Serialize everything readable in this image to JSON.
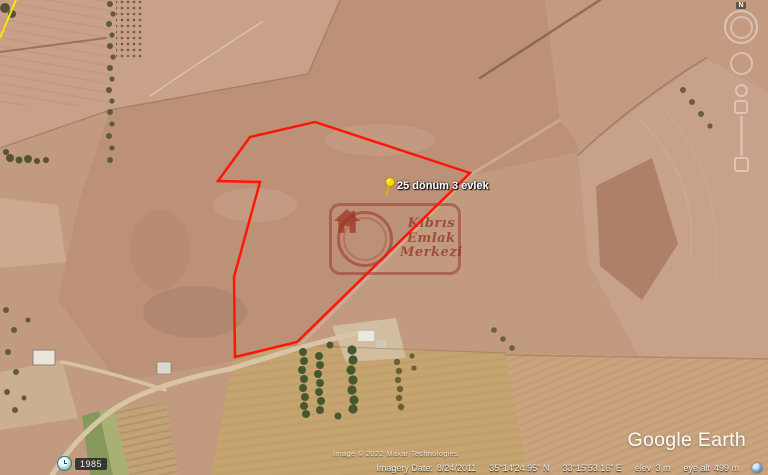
{
  "placemark": {
    "label": "25 dönüm 3 evlek"
  },
  "watermark": {
    "line1": "Kıbrıs",
    "line2": "Emlak",
    "line3": "Merkezi"
  },
  "nav": {
    "north_label": "N"
  },
  "time_badge": {
    "year": "1985"
  },
  "branding": {
    "logo": "Google Earth"
  },
  "status_bar": {
    "imagery_date_label": "Imagery Date:",
    "imagery_date": "8/24/2011",
    "latitude": "35°14'24.95\" N",
    "longitude": "33°15'53.16\" E",
    "elev_label": "elev",
    "elevation": "3 m",
    "eye_alt_label": "eye alt",
    "eye_altitude": "499 m",
    "copyright": "Image © 2022 Maxar Technologies"
  },
  "colors": {
    "parcel_boundary": "#ff1605",
    "adjacent_boundary": "#ffe400",
    "pin": "#ffd903",
    "watermark": "#993d2d"
  }
}
